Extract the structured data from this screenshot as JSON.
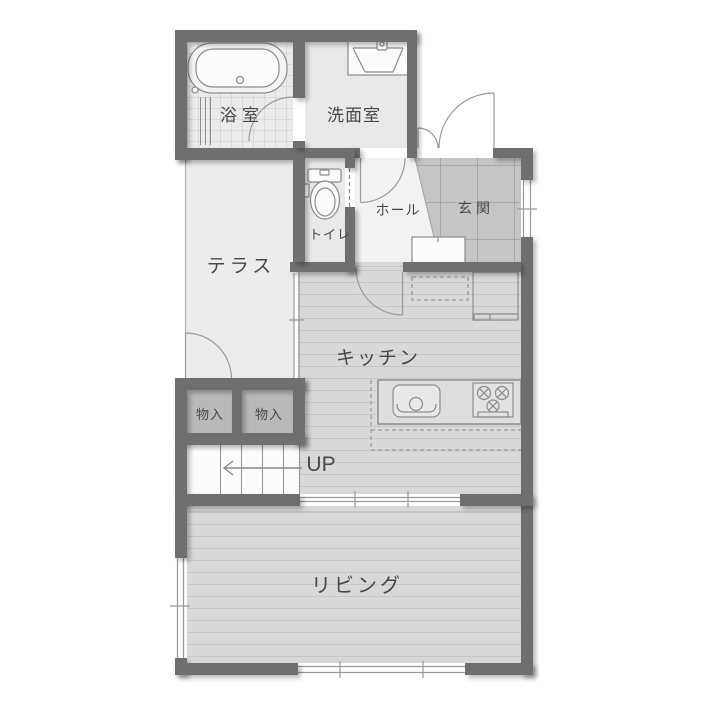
{
  "type": "floor-plan",
  "rooms": {
    "bathroom": {
      "label": "浴室"
    },
    "washroom": {
      "label": "洗面室"
    },
    "toilet": {
      "label": "トイレ"
    },
    "hall": {
      "label": "ホール"
    },
    "entrance": {
      "label": "玄関"
    },
    "terrace": {
      "label": "テラス"
    },
    "kitchen": {
      "label": "キッチン"
    },
    "storage_left": {
      "label": "物入"
    },
    "storage_right": {
      "label": "物入"
    },
    "stairs": {
      "label": "UP"
    },
    "living": {
      "label": "リビング"
    }
  },
  "palette": {
    "wall": "#6f6f6f",
    "wood_floor": "#d8d8d8",
    "entrance_floor": "#c5c5c5",
    "storage_floor": "#b9b9b9",
    "bathroom_floor": "#ebebeb",
    "hall_floor": "#f2f2f2",
    "terrace_floor": "#ececec",
    "fixture_stroke": "#8d8d8d",
    "door_stroke": "#9b9b9b",
    "text": "#474747"
  }
}
